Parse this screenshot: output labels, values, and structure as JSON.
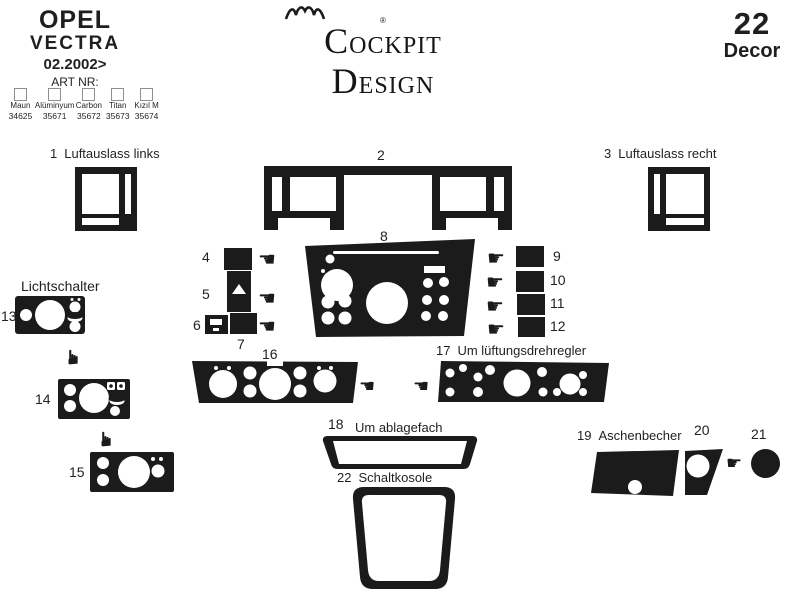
{
  "header": {
    "brand": "OPEL",
    "model": "VECTRA",
    "date": "02.2002>",
    "art_nr": "ART NR:",
    "swatches": [
      {
        "name": "Maun",
        "code": "34625"
      },
      {
        "name": "Alüminyum",
        "code": "35671"
      },
      {
        "name": "Carbon",
        "code": "35672"
      },
      {
        "name": "Titan",
        "code": "35673"
      },
      {
        "name": "Kızıl M",
        "code": "35674"
      }
    ],
    "logo": {
      "left": "COCKPIT",
      "right": "DESIGN",
      "registered": "®"
    },
    "decor": {
      "count": "22",
      "label": "Decor"
    }
  },
  "labels": {
    "p1": "Luftauslass links",
    "p3": "Luftauslass recht",
    "p13": "Lichtschalter",
    "p17": "Um lüftungsdrehregler",
    "p18": "Um ablagefach",
    "p19": "Aschenbecher",
    "p22": "Schaltkosole"
  },
  "numbers": {
    "n1": "1",
    "n2": "2",
    "n3": "3",
    "n4": "4",
    "n5": "5",
    "n6": "6",
    "n7": "7",
    "n8": "8",
    "n9": "9",
    "n10": "10",
    "n11": "11",
    "n12": "12",
    "n13": "13",
    "n14": "14",
    "n15": "15",
    "n16": "16",
    "n17": "17",
    "n18": "18",
    "n19": "19",
    "n20": "20",
    "n21": "21",
    "n22": "22"
  },
  "icons": {
    "hand_left": "☚",
    "hand_right": "☛"
  },
  "colors": {
    "ink": "#1b1b1b",
    "background": "#ffffff",
    "checkbox_border": "#8f8f8f"
  }
}
